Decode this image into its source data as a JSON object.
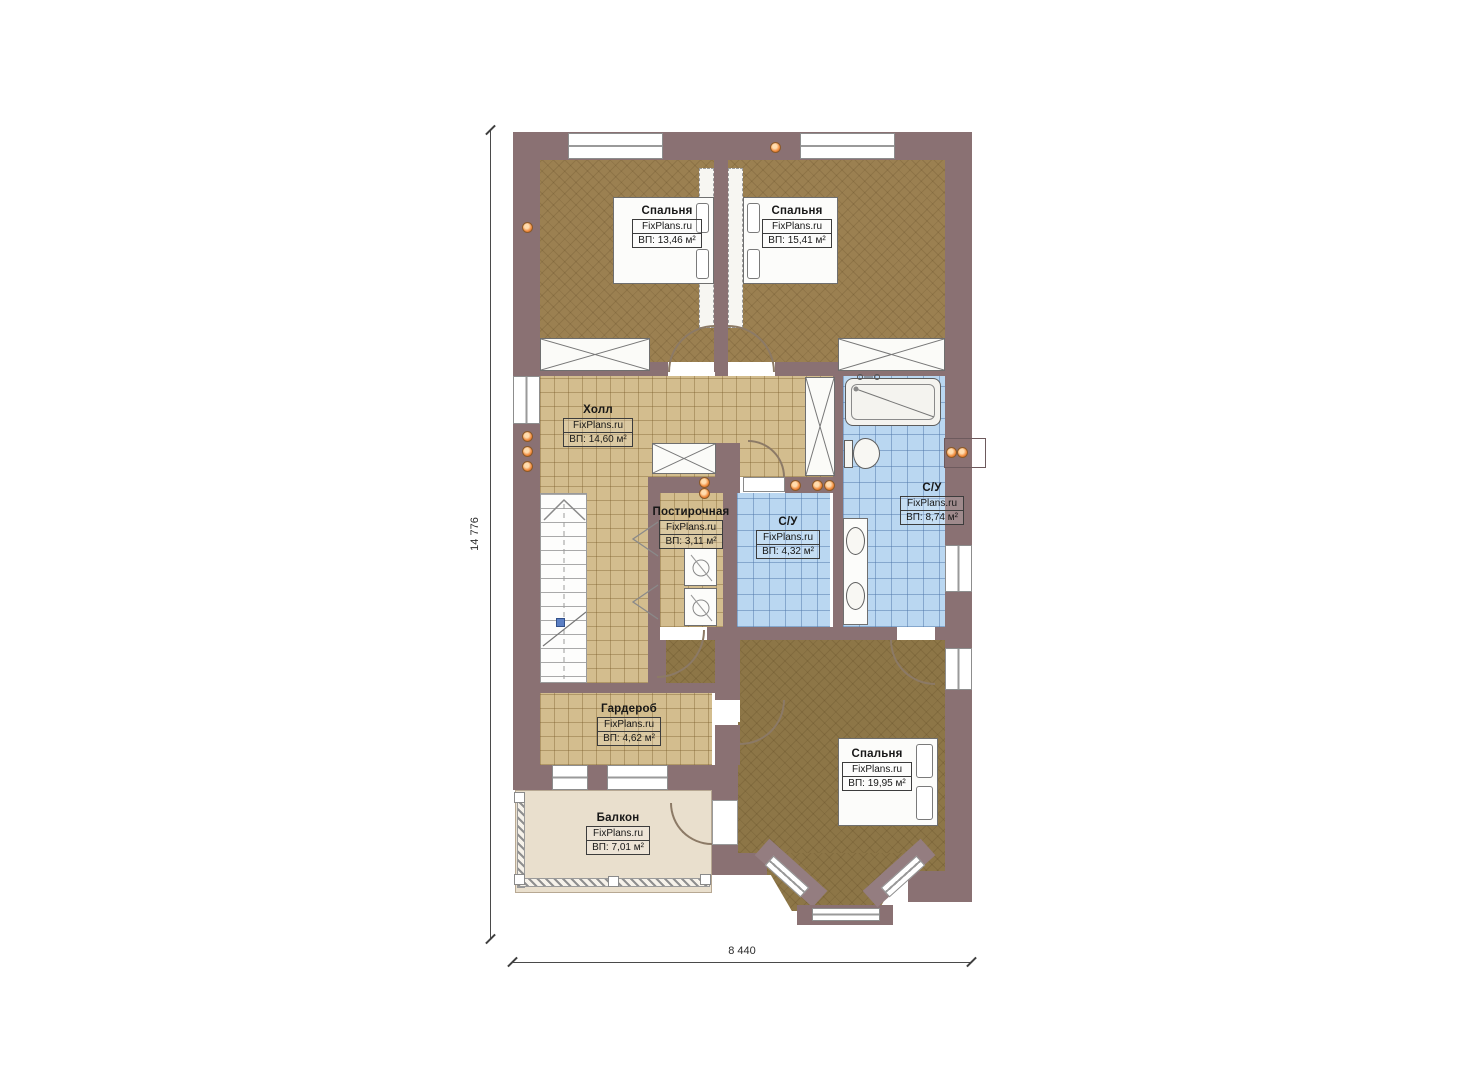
{
  "plan": {
    "rooms": [
      {
        "name": "Спальня",
        "brand": "FixPlans.ru",
        "area": "ВП: 13,46 м²"
      },
      {
        "name": "Спальня",
        "brand": "FixPlans.ru",
        "area": "ВП: 15,41 м²"
      },
      {
        "name": "Холл",
        "brand": "FixPlans.ru",
        "area": "ВП: 14,60 м²"
      },
      {
        "name": "Постирочная",
        "brand": "FixPlans.ru",
        "area": "ВП: 3,11 м²"
      },
      {
        "name": "С/У",
        "brand": "FixPlans.ru",
        "area": "ВП: 4,32 м²"
      },
      {
        "name": "С/У",
        "brand": "FixPlans.ru",
        "area": "ВП: 8,74 м²"
      },
      {
        "name": "Гардероб",
        "brand": "FixPlans.ru",
        "area": "ВП: 4,62 м²"
      },
      {
        "name": "Балкон",
        "brand": "FixPlans.ru",
        "area": "ВП: 7,01 м²"
      },
      {
        "name": "Спальня",
        "brand": "FixPlans.ru",
        "area": "ВП: 19,95 м²"
      }
    ],
    "dimensions": {
      "height": "14 776",
      "width": "8 440"
    },
    "colors": {
      "wall": "#8a7173",
      "wood_floor": "#9b8051",
      "tile_tan": "#d3bd8e",
      "tile_blue": "#bad7f1",
      "balcony_floor": "#e9dfcd",
      "light_dot": "#f08a3c"
    }
  }
}
